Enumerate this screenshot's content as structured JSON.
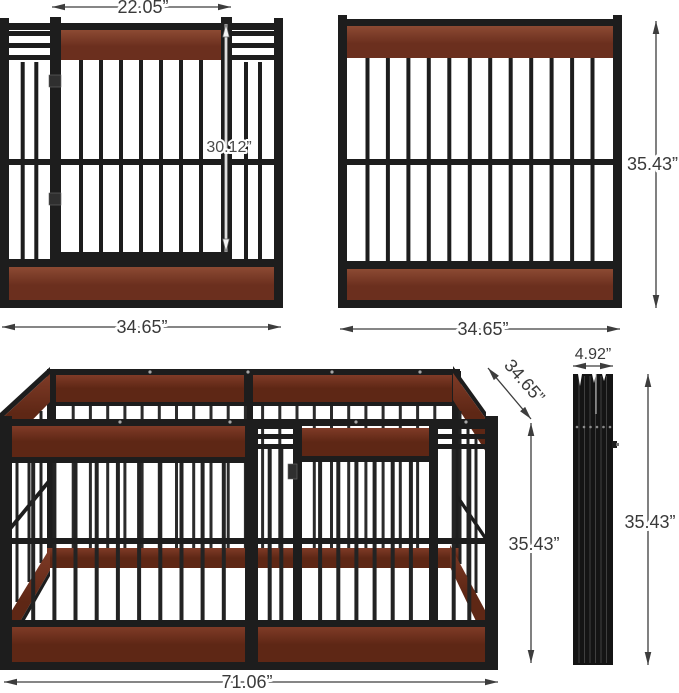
{
  "figure": {
    "views": {
      "door_panel": {
        "door_width_label": "22.05”",
        "door_height_label": "30.12”",
        "panel_width_label": "34.65”"
      },
      "full_panel": {
        "height_label": "35.43”",
        "width_label": "34.65”"
      },
      "assembled": {
        "length_label": "71.06”",
        "depth_label": "34.65”",
        "height_label": "35.43”"
      },
      "folded": {
        "width_label": "4.92”",
        "height_label": "35.43”"
      }
    },
    "colors": {
      "background": "#ffffff",
      "metal": "#1d1d1d",
      "bar": "#232323",
      "back_bar": "#2b2b2b",
      "wood_light": "#8c4a33",
      "wood_dark": "#6b2f1e",
      "wood3d_light": "#7f3b27",
      "wood3d_dark": "#5e2715",
      "dimension_line": "#3d3d3d",
      "label_text": "#3a3a3a"
    }
  }
}
